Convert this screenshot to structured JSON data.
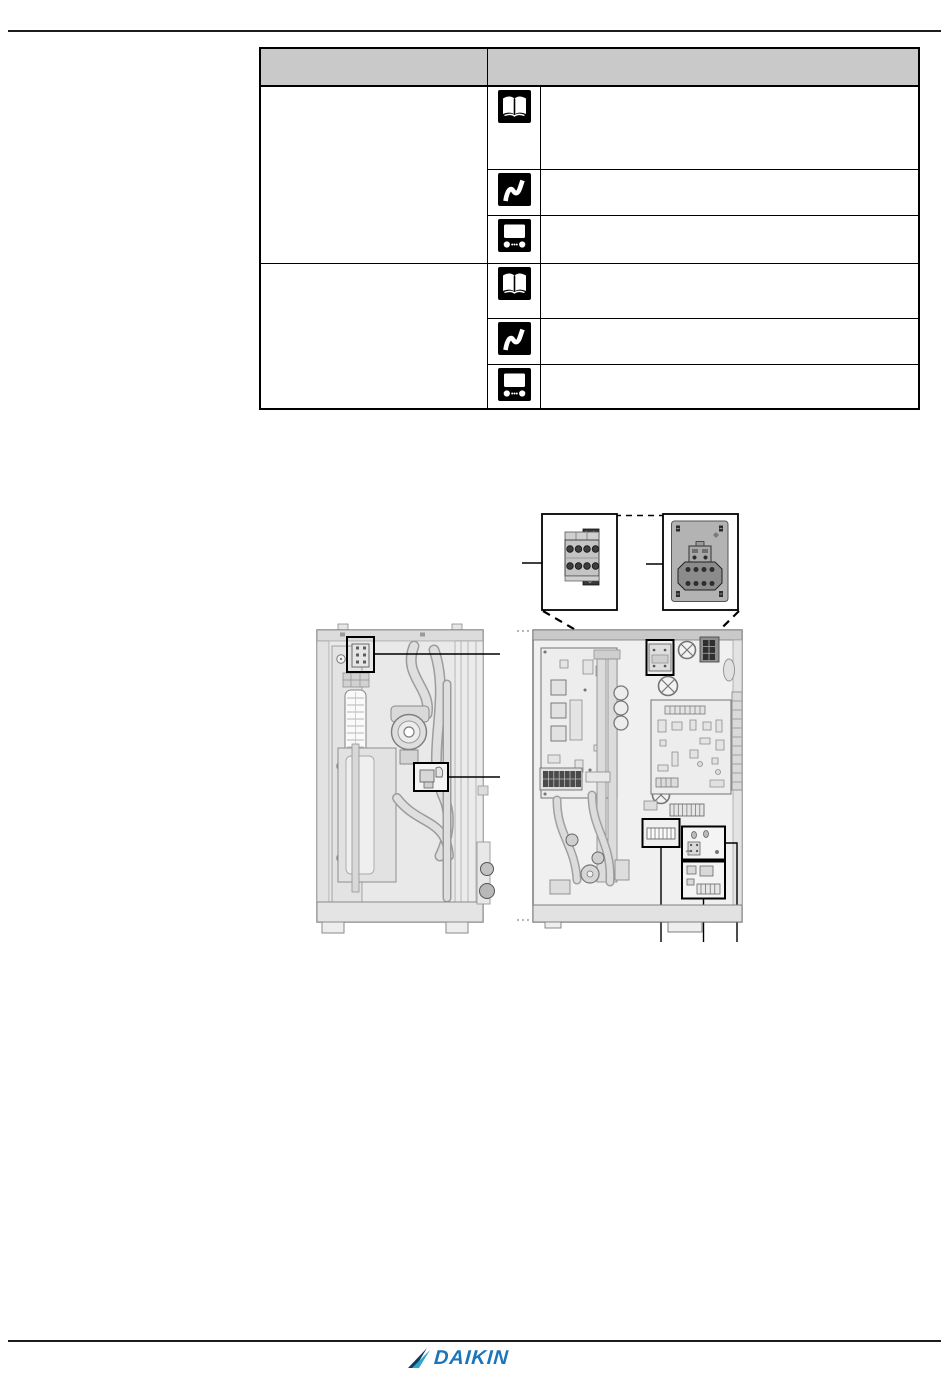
{
  "page": {
    "background": "#ffffff",
    "rule_color": "#1c1c1c"
  },
  "table": {
    "style": {
      "header_bg": "#c9c9c9",
      "border_color": "#000000",
      "icon_bg": "#000000",
      "icon_glyph": "#ffffff"
    },
    "header": {
      "col1": "",
      "col2": ""
    },
    "sections": [
      {
        "label": "",
        "rows": [
          {
            "icon": "operation-manual-icon",
            "text": ""
          },
          {
            "icon": "reference-guide-icon",
            "text": ""
          },
          {
            "icon": "user-interface-icon",
            "text": ""
          }
        ]
      },
      {
        "label": "",
        "rows": [
          {
            "icon": "operation-manual-icon",
            "text": ""
          },
          {
            "icon": "reference-guide-icon",
            "text": ""
          },
          {
            "icon": "user-interface-icon",
            "text": ""
          }
        ]
      }
    ]
  },
  "diagram": {
    "colors": {
      "drawing_stroke": "#7d7d7d",
      "drawing_fill": "#ededed",
      "highlight": "#000000",
      "detail_panel": "#b3b3b3"
    },
    "detail_boxes": [
      "terminal-block-detail",
      "terminal-block-on-plate-detail"
    ],
    "highlighted_components": [
      "front-view-connector",
      "front-view-valve",
      "switchbox-top-component",
      "switchbox-terminal-strip",
      "switchbox-small-pcb-upper",
      "switchbox-small-pcb-lower"
    ]
  },
  "footer": {
    "brand": "DAIKIN",
    "brand_text_color": "#1b75bb",
    "brand_mark_colors": [
      "#123a5e",
      "#2ea7cc"
    ]
  }
}
